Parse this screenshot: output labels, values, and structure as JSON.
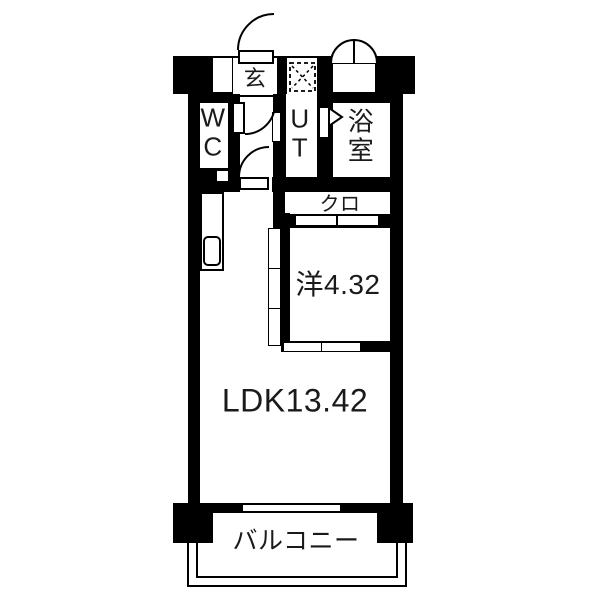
{
  "plan": {
    "kind": "japanese-apartment-floor-plan",
    "rooms": {
      "genkan": {
        "label": "玄"
      },
      "wc": {
        "line1": "W",
        "line2": "C"
      },
      "ut": {
        "line1": "U",
        "line2": "T"
      },
      "bath": {
        "line1": "浴",
        "line2": "室"
      },
      "closet": {
        "label": "クロ"
      },
      "western_room": {
        "label": "洋4.32"
      },
      "ldk": {
        "label": "LDK13.42"
      },
      "balcony": {
        "label": "バルコニー"
      }
    },
    "colors": {
      "wall": "#000000",
      "floor": "#ffffff",
      "text": "#1a1a1a"
    }
  }
}
